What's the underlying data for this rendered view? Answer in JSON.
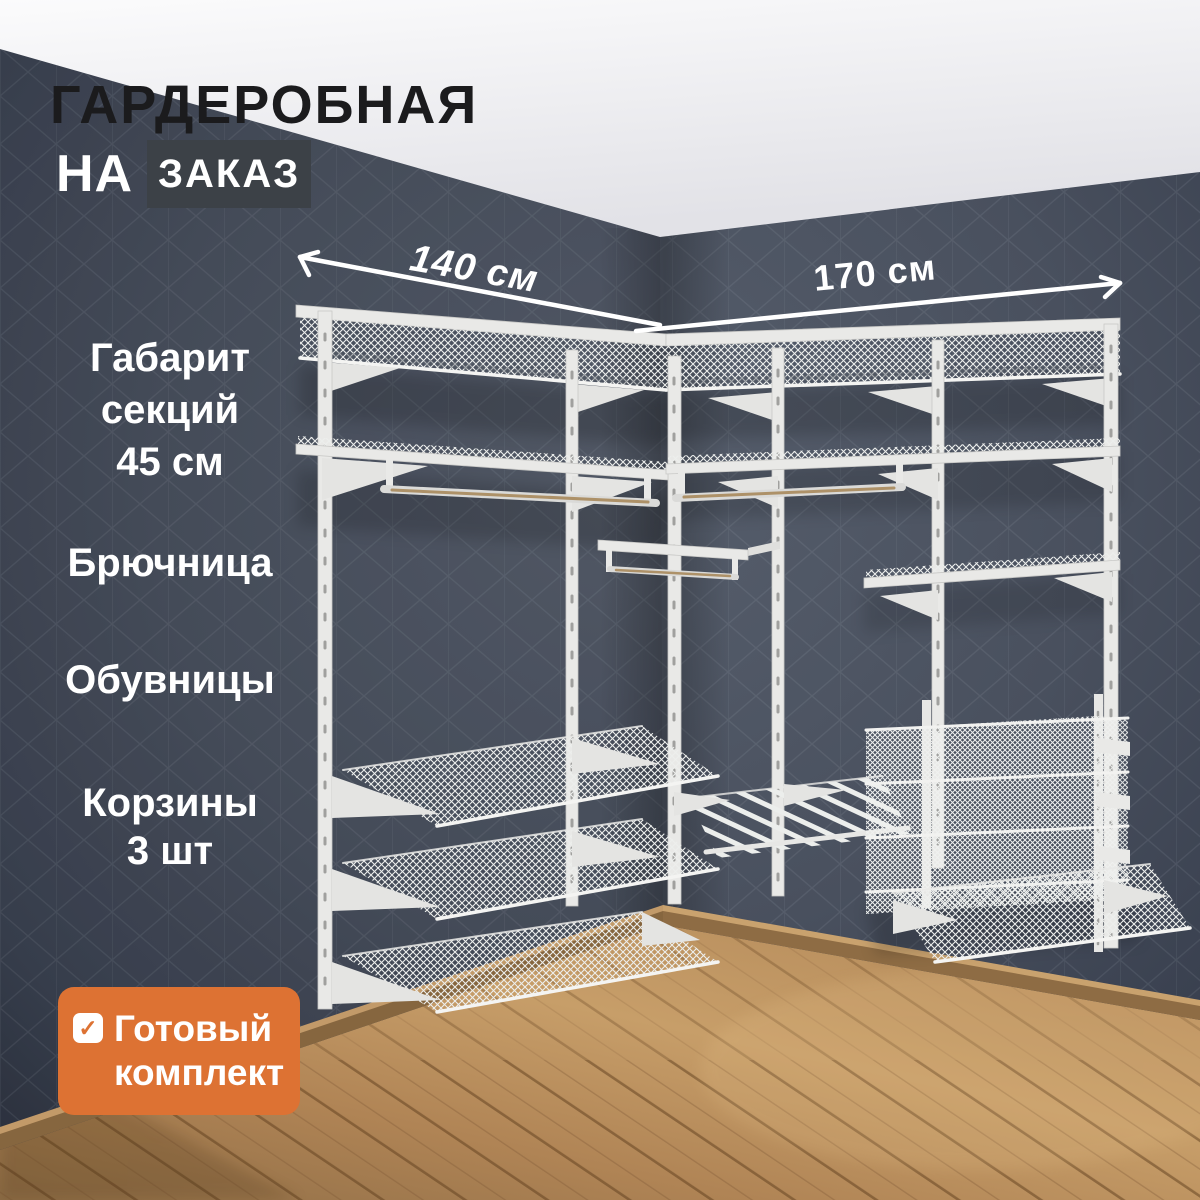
{
  "header": {
    "title": "ГАРДЕРОБНАЯ",
    "subtitle_prefix": "НА",
    "subtitle_badge": "ЗАКАЗ"
  },
  "dimensions": {
    "left_wall": "140 см",
    "right_wall": "170 см"
  },
  "features": [
    {
      "id": "section-size",
      "lines": [
        "Габарит",
        "секций",
        "45 см"
      ]
    },
    {
      "id": "pants-rack",
      "lines": [
        "Брючница"
      ]
    },
    {
      "id": "shoe-racks",
      "lines": [
        "Обувницы"
      ]
    },
    {
      "id": "baskets",
      "lines": [
        "Корзины",
        "3 шт"
      ]
    }
  ],
  "badge": {
    "check_glyph": "✓",
    "line1": "Готовый",
    "line2": "комплект"
  },
  "colors": {
    "accent_orange": "#DD7233",
    "subtitle_box": "#3C4147",
    "wall": "#49515F",
    "ceiling": "#F4F4F6",
    "floor": "#BE9462",
    "baseboard": "#8E6C44",
    "structure_white": "#E9E9E7",
    "rod_brass": "#AD9168",
    "title_text": "#1B1B1D",
    "label_text": "#FFFFFF"
  }
}
